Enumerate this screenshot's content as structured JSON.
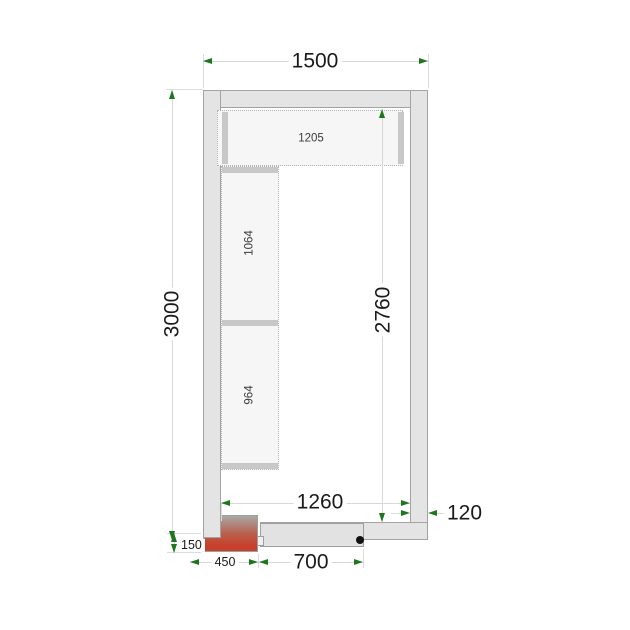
{
  "drawing": {
    "title": "cold-room-floor-plan",
    "dims": {
      "outer_width": "1500",
      "outer_height": "3000",
      "inner_height": "2760",
      "inner_width": "1260",
      "wall_thickness": "120",
      "door_width": "700",
      "unit_width": "450",
      "unit_offset": "150"
    },
    "shelves": {
      "top_label": "1205",
      "left_upper_label": "1064",
      "left_lower_label": "964"
    },
    "colors": {
      "wall_fill": "#e4e4e4",
      "wall_border": "#a3a3a3",
      "shelf_fill": "#f6f6f6",
      "shelf_border": "#b5b5b5",
      "shelf_cap": "#c8c8c8",
      "dim_line": "#d8d8d8",
      "arrow": "#1d781d",
      "unit_top": "#a8a8a6",
      "unit_bottom": "#c7402b",
      "text": "#1a1a1a"
    }
  }
}
